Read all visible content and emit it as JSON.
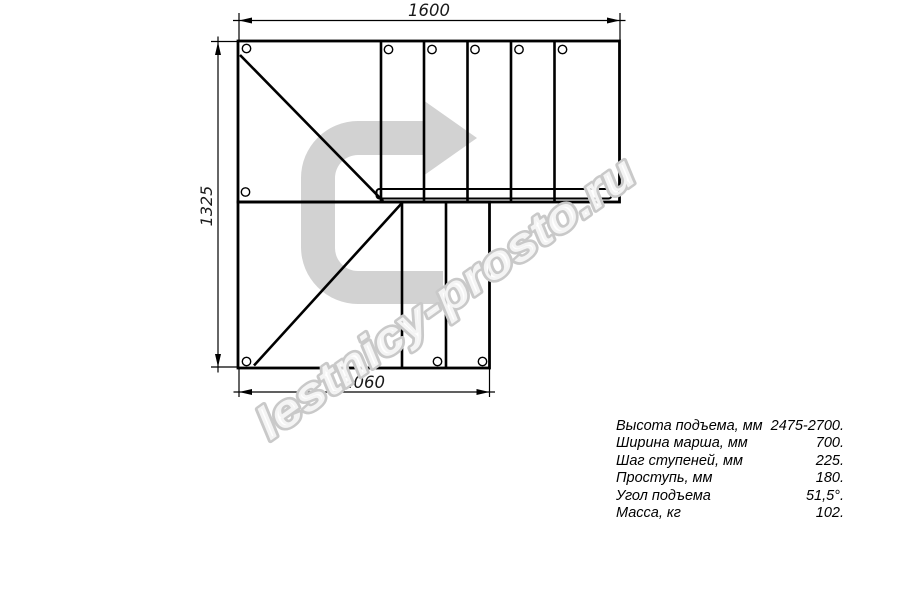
{
  "drawing": {
    "dim_top": "1600",
    "dim_left": "1325",
    "dim_bottom": "1060",
    "watermark": "lestnicy-prosto.ru",
    "colors": {
      "line": "#000000",
      "arrow_fill": "#d2d2d2",
      "watermark_outline": "#c9c9c9"
    }
  },
  "specs": {
    "rows": [
      {
        "label": "Высота подъема, мм",
        "value": "2475-2700."
      },
      {
        "label": "Ширина марша, мм",
        "value": "700."
      },
      {
        "label": "Шаг ступеней, мм",
        "value": "225."
      },
      {
        "label": "Проступь, мм",
        "value": "180."
      },
      {
        "label": "Угол подъема",
        "value": "51,5°."
      },
      {
        "label": "Масса, кг",
        "value": "102."
      }
    ]
  }
}
